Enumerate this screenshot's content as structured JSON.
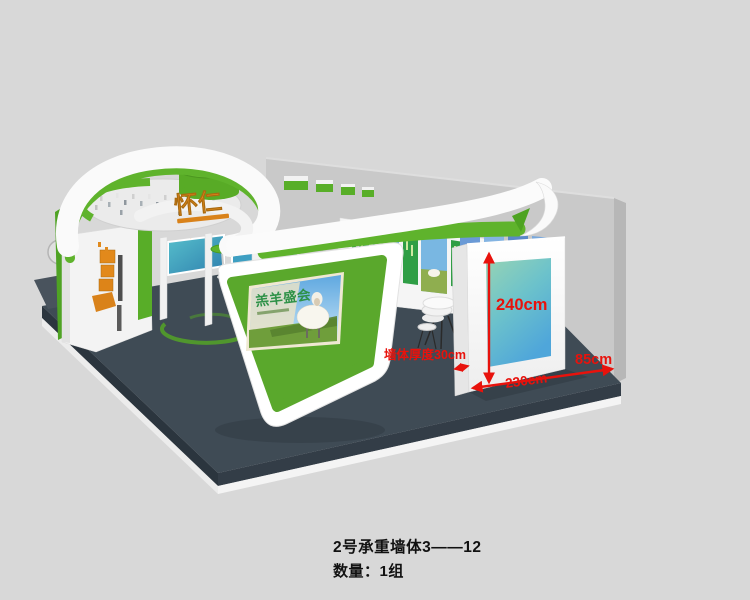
{
  "colors": {
    "background": "#d8d8d8",
    "accent_green": "#5fb32c",
    "floor_slate": "#3f4b55",
    "backdrop_gray": "#c9c9c9",
    "annotation_red": "#e8120c",
    "panel_teal_top": "#97d4b4",
    "panel_blue_bottom": "#4fa6da",
    "logo_orange": "#e2891b"
  },
  "booth": {
    "logo": "怀仁",
    "screen_title": "羔羊盛会"
  },
  "annotations": {
    "height": "240cm",
    "width": "230cm",
    "side": "85cm",
    "thickness": "墙体厚度30cm"
  },
  "caption": {
    "title": "2号承重墙体3——12",
    "quantity": "数量：1组"
  }
}
